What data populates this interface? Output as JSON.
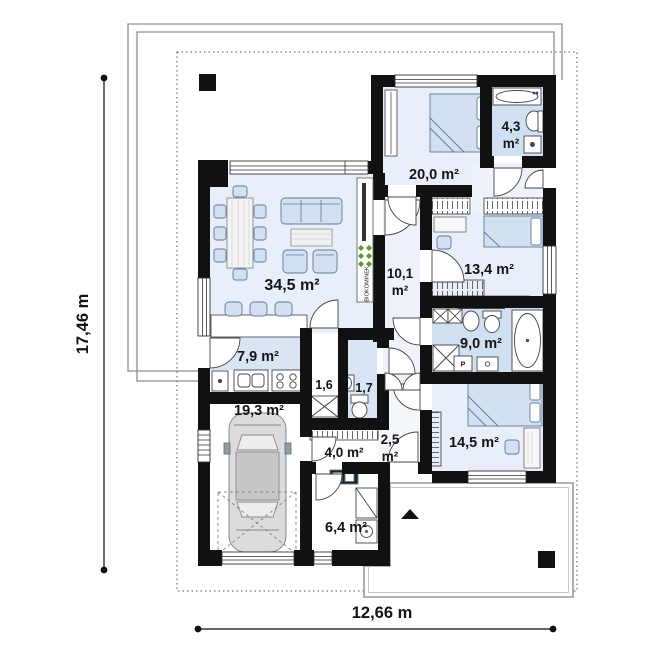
{
  "plan": {
    "dimensions": {
      "height_label": "17,46 m",
      "width_label": "12,66 m"
    },
    "rooms": {
      "living": "34,5 m²",
      "kitchen": "7,9 m²",
      "garage": "19,3 m²",
      "bedroom_main": "20,0 m²",
      "bath_small": {
        "area": "4,3",
        "unit": "m²"
      },
      "corridor": {
        "area": "10,1",
        "unit": "m²"
      },
      "bedroom_2": "13,4 m²",
      "bathroom": "9,0 m²",
      "bedroom_3": "14,5 m²",
      "pantry": "1,6",
      "wc": "1,7",
      "hall": "4,0 m²",
      "vestibule": {
        "area": "2,5",
        "unit": "m²"
      },
      "utility": "6,4 m²"
    },
    "fireplace_label": "BIOKOMINEK",
    "washer_label": "P",
    "colors": {
      "wall": "#111111",
      "room_fill": "#e9effa",
      "wet_room_fill": "#cfe0f3",
      "kitchen_fill": "#d9e5f4",
      "corridor_fill": "#eef3fb",
      "furniture_fill": "#d3e0f1",
      "plant_green": "#5a9e1e"
    }
  }
}
